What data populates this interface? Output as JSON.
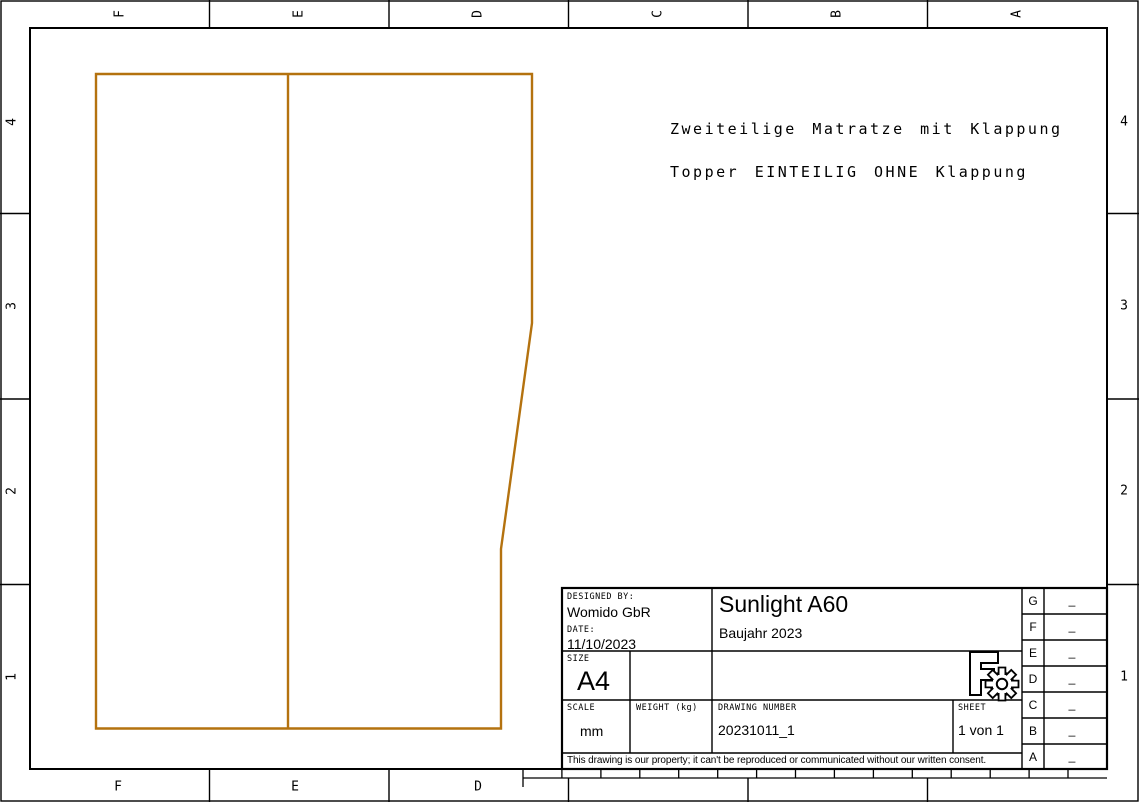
{
  "colors": {
    "line": "#000000",
    "part_outline": "#b4720f"
  },
  "notes": {
    "line1": "Zweiteilige Matratze mit Klappung",
    "line2": "Topper EINTEILIG OHNE Klappung"
  },
  "zones": {
    "top": [
      "F",
      "E",
      "D",
      "C",
      "B",
      "A"
    ],
    "bottom": [
      "F",
      "E",
      "D"
    ],
    "left": [
      "4",
      "3",
      "2",
      "1"
    ],
    "right": [
      "4",
      "3",
      "2",
      "1"
    ]
  },
  "title_block": {
    "designed_by_label": "DESIGNED BY:",
    "designed_by": "Womido GbR",
    "date_label": "DATE:",
    "date": "11/10/2023",
    "title": "Sunlight A60",
    "subtitle": "Baujahr 2023",
    "size_label": "SIZE",
    "size": "A4",
    "scale_label": "SCALE",
    "scale": "mm",
    "weight_label": "WEIGHT (kg)",
    "weight": "",
    "drawing_number_label": "DRAWING NUMBER",
    "drawing_number": "20231011_1",
    "sheet_label": "SHEET",
    "sheet": "1 von 1",
    "disclaimer": "This drawing is our property; it can't be reproduced or communicated without our written consent.",
    "logo": "freecad-gear-logo"
  },
  "revision_table": {
    "rows": [
      {
        "zone": "G",
        "rev": "_"
      },
      {
        "zone": "F",
        "rev": "_"
      },
      {
        "zone": "E",
        "rev": "_"
      },
      {
        "zone": "D",
        "rev": "_"
      },
      {
        "zone": "C",
        "rev": "_"
      },
      {
        "zone": "B",
        "rev": "_"
      },
      {
        "zone": "A",
        "rev": "_"
      }
    ]
  }
}
